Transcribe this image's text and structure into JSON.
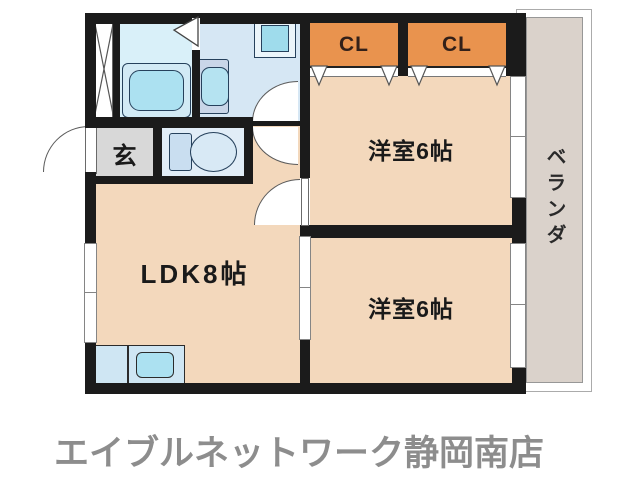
{
  "plan": {
    "closets": {
      "cl1": "CL",
      "cl2": "CL"
    },
    "rooms": {
      "western1": "洋室6帖",
      "western2": "洋室6帖",
      "ldk": "LDK8帖",
      "entrance": "玄",
      "veranda": "ベランダ"
    },
    "colors": {
      "wall": "#1b1b1b",
      "room": "#F3D8BC",
      "closet": "#E9934E",
      "bath": "#D9F0F9",
      "washroom": "#D6E7F4",
      "toilet_room": "#E1EDF7",
      "entrance_floor": "#D8D8D8",
      "veranda": "#DAD2CB",
      "kitchen": "#CFE6F3",
      "fixture": "#ACE1F1",
      "fixture_dark": "#9FDCEC",
      "vanity": "#C9D6E8",
      "tank": "#C9DEF0",
      "bowl": "#D8E9F5",
      "cl_text": "#332019",
      "label": "#1a1a1a",
      "store_text": "#8d8d8d"
    }
  },
  "footer": {
    "store_name": "エイブルネットワーク静岡南店"
  }
}
